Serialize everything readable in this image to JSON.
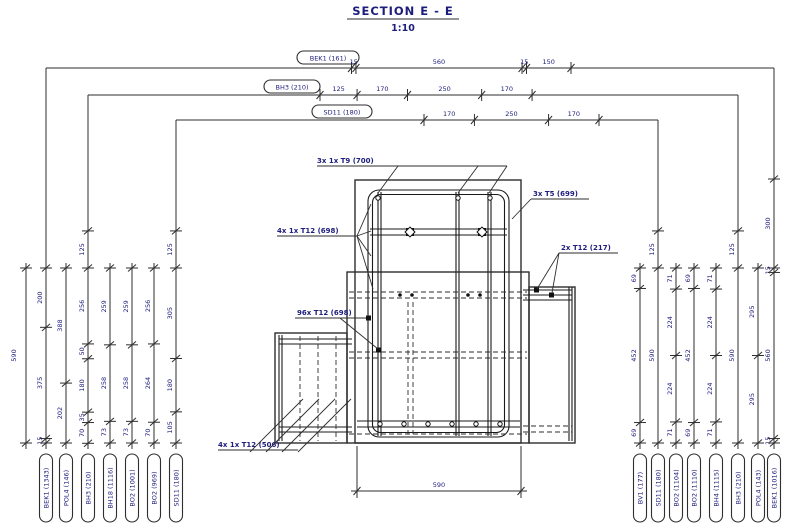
{
  "title": {
    "text": "SECTION E - E",
    "scale": "1:10"
  },
  "top_dims": [
    {
      "label": "BEK1 (161)",
      "segments": [
        "15",
        "560",
        "15",
        "150"
      ]
    },
    {
      "label": "BH3 (210)",
      "segments": [
        "125",
        "170",
        "250",
        "170"
      ]
    },
    {
      "label": "SD11 (180)",
      "segments": [
        "170",
        "250",
        "170"
      ]
    }
  ],
  "left_total": "590",
  "left_chains": [
    {
      "oval": "BEK1 (1343)",
      "segments": [
        "200",
        "375",
        "15"
      ]
    },
    {
      "oval": "POL4 (146)",
      "segments": [
        "388",
        "202"
      ]
    },
    {
      "oval": "BH3 (210)",
      "above": "125",
      "segments": [
        "256",
        "50",
        "180",
        "35",
        "70"
      ]
    },
    {
      "oval": "BH18 (1116)",
      "segments": [
        "259",
        "258",
        "73"
      ]
    },
    {
      "oval": "BO2 (1001)",
      "segments": [
        "259",
        "258",
        "73"
      ]
    },
    {
      "oval": "BO2 (969)",
      "segments": [
        "256",
        "264",
        "70"
      ]
    },
    {
      "oval": "SD11 (180)",
      "above": "125",
      "segments": [
        "305",
        "180",
        "105"
      ]
    }
  ],
  "right_chains": [
    {
      "oval": "BV1 (177)",
      "segments": [
        "69",
        "452",
        "69"
      ]
    },
    {
      "oval": "SD11 (180)",
      "above": "125",
      "segments": [
        "590"
      ]
    },
    {
      "oval": "BO2 (1104)",
      "segments": [
        "71",
        "224",
        "224",
        "71"
      ]
    },
    {
      "oval": "BO2 (1110)",
      "segments": [
        "69",
        "452",
        "69"
      ]
    },
    {
      "oval": "BH4 (1115)",
      "segments": [
        "71",
        "224",
        "224",
        "71"
      ]
    },
    {
      "oval": "BH3 (210)",
      "above": "125",
      "segments": [
        "590"
      ]
    },
    {
      "oval": "POL4 (143)",
      "segments": [
        "295",
        "295"
      ]
    },
    {
      "oval": "BEK1 (1016)",
      "above": "300",
      "segments": [
        "15",
        "560",
        "15"
      ]
    }
  ],
  "annotations": {
    "t9": "3x 1x T9 (700)",
    "t5": "3x T5 (699)",
    "t12_top": "4x 1x T12 (698)",
    "t12_right": "2x T12 (217)",
    "t12_mid": "96x T12 (698)",
    "t12_bottom": "4x 1x T12 (506)"
  },
  "bottom_dim": "590",
  "colors": {
    "line": "#2e2e2e",
    "text": "#1d1d7c"
  }
}
